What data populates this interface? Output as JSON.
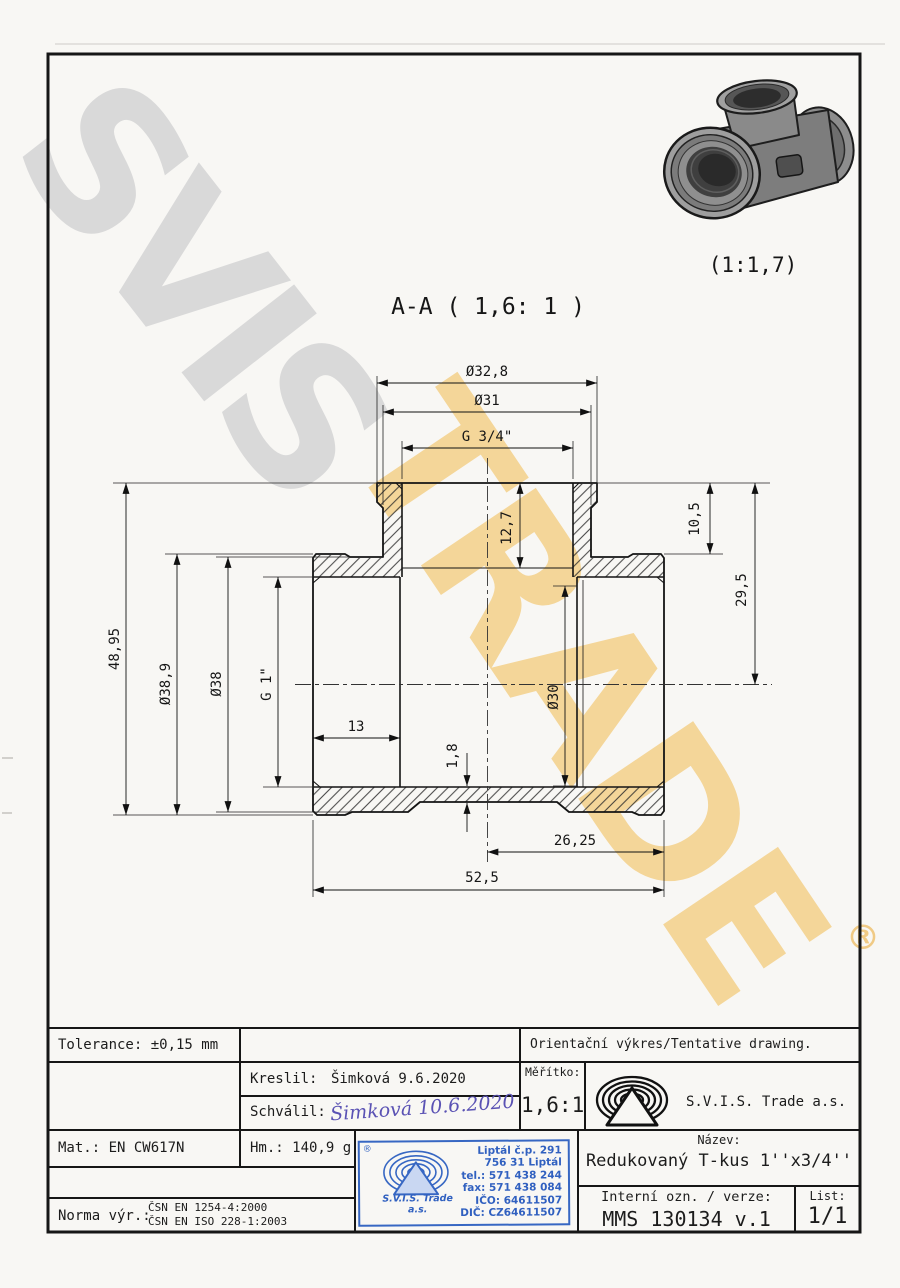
{
  "page": {
    "bg": "#f8f7f4",
    "line_color": "#161616",
    "accent_blue": "#3767c3",
    "signature_ink": "#5a52b4"
  },
  "watermark": {
    "word1": "SVIS",
    "word2": "TRADE",
    "registered": "®",
    "gray": "#d9d9d9",
    "orange": "#f4cf86"
  },
  "pictorial": {
    "caption": "(1:1,7)"
  },
  "drawing": {
    "section_title": "A-A ( 1,6: 1 )",
    "dims": {
      "top_od": "Ø32,8",
      "top_id": "Ø31",
      "top_thread": "G 3/4\"",
      "height": "48,95",
      "run_od_collar": "Ø38,9",
      "run_od": "Ø38",
      "run_thread": "G 1\"",
      "thread_depth": "13",
      "wall": "1,8",
      "branch_depth": "12,7",
      "bore": "Ø30",
      "collar_h": "10,5",
      "axis_h": "29,5",
      "half_len": "26,25",
      "len": "52,5"
    }
  },
  "titleblock": {
    "tolerance": "Tolerance: ±0,15 mm",
    "orientacni": "Orientační výkres/Tentative drawing.",
    "kreslil_label": "Kreslil:",
    "kreslil_value": "Šimková 9.6.2020",
    "schvalil_label": "Schválil:",
    "schvalil_signature": "Šimková 10.6.2020",
    "meritko_label": "Měřítko:",
    "meritko_value": "1,6:1",
    "company": "S.V.I.S. Trade a.s.",
    "mat": "Mat.: EN CW617N",
    "hm": "Hm.: 140,9 g",
    "norma_label": "Norma výr.:",
    "norma_line1": "ČSN EN 1254-4:2000",
    "norma_line2": "ČSN EN ISO 228-1:2003",
    "nazev_label": "Název:",
    "nazev_value": "Redukovaný T-kus 1''x3/4''",
    "interni_label": "Interní ozn. / verze:",
    "interni_value": "MMS 130134 v.1",
    "list_label": "List:",
    "list_value": "1/1"
  },
  "stamp": {
    "line1": "Liptál č.p. 291",
    "line2": "756 31 Liptál",
    "line3": "tel.: 571 438 244",
    "line4": "fax: 571 438 084",
    "line5": "IČO: 64611507",
    "line6": "DIČ: CZ64611507",
    "company1": "S.V.I.S. Trade",
    "company2": "a.s.",
    "registered": "®"
  }
}
